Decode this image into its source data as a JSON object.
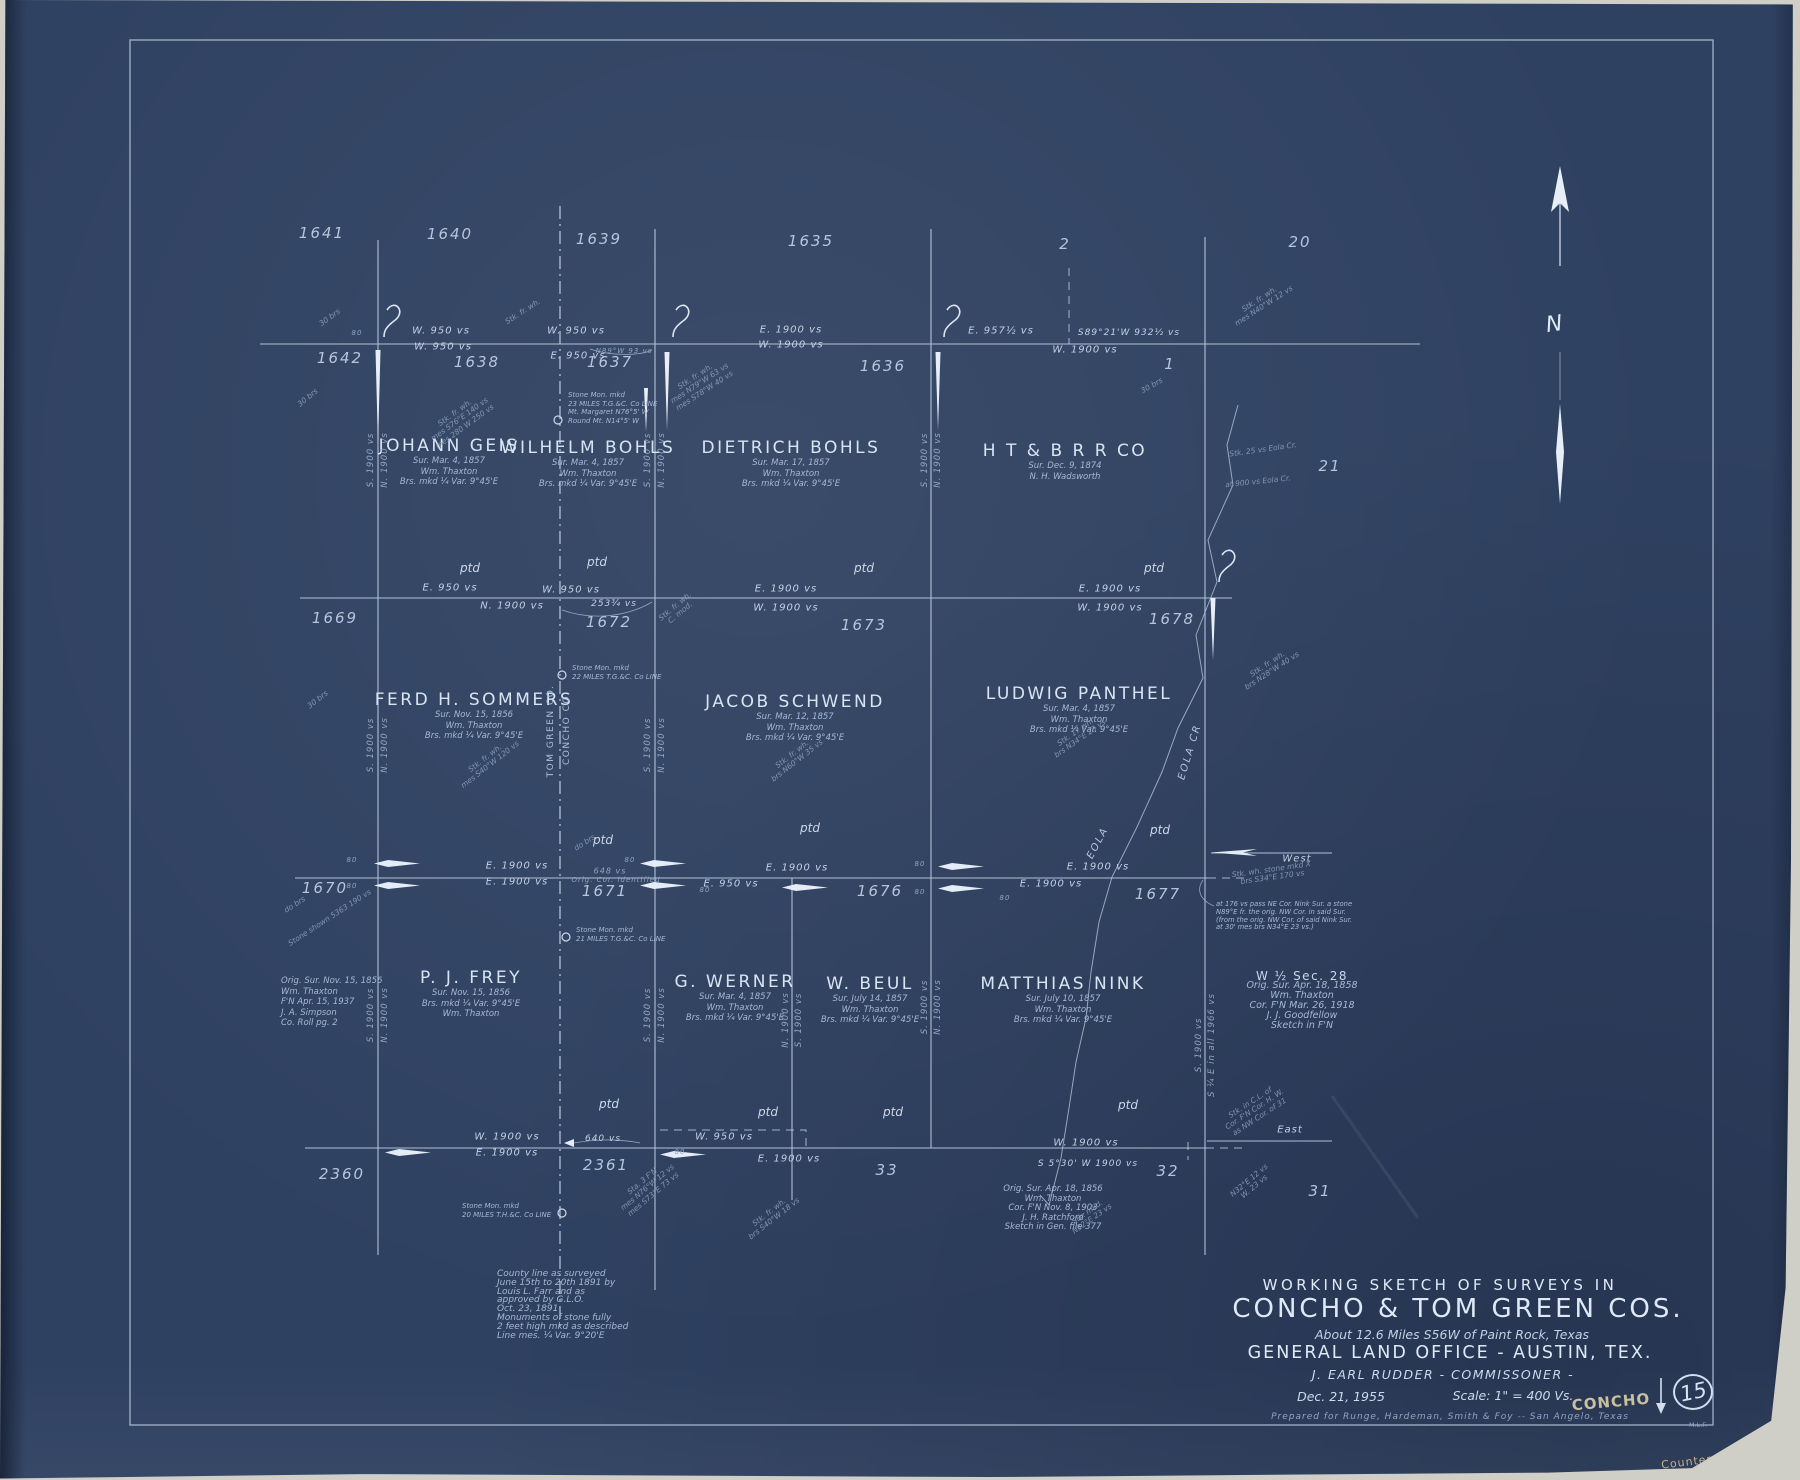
{
  "colors": {
    "paper": "#2f4161",
    "ink": "#c6d4e6",
    "ink_bright": "#e2ebf7",
    "ink_dim": "#8fa5c4",
    "pencil": "#bfb388"
  },
  "compass": {
    "letter": "N"
  },
  "title_block": {
    "line1": "WORKING SKETCH OF SURVEYS IN",
    "line2": "CONCHO & TOM GREEN COS.",
    "line3": "About 12.6 Miles S56W of Paint Rock, Texas",
    "line4": "GENERAL LAND OFFICE - AUSTIN, TEX.",
    "line5": "J. EARL RUDDER - COMMISSONER -",
    "date": "Dec. 21, 1955",
    "scale": "Scale: 1\" = 400 Vs.",
    "prepared": "Prepared for Runge, Hardeman, Smith & Foy -- San Angelo, Texas",
    "county_stamp": "CONCHO",
    "sheet_number": "15",
    "initials": "M.L.F.",
    "counter_note": "Counter # 68197"
  },
  "map": {
    "ptd_label": "ptd",
    "section_numbers": [
      {
        "t": "1641",
        "x": 322,
        "y": 233
      },
      {
        "t": "1640",
        "x": 450,
        "y": 234
      },
      {
        "t": "1639",
        "x": 599,
        "y": 239
      },
      {
        "t": "1635",
        "x": 811,
        "y": 241
      },
      {
        "t": "2",
        "x": 1065,
        "y": 244
      },
      {
        "t": "20",
        "x": 1300,
        "y": 242
      },
      {
        "t": "1642",
        "x": 340,
        "y": 358
      },
      {
        "t": "1638",
        "x": 477,
        "y": 362
      },
      {
        "t": "1637",
        "x": 610,
        "y": 362
      },
      {
        "t": "1636",
        "x": 883,
        "y": 366
      },
      {
        "t": "1",
        "x": 1170,
        "y": 364
      },
      {
        "t": "21",
        "x": 1330,
        "y": 466
      },
      {
        "t": "1669",
        "x": 335,
        "y": 618
      },
      {
        "t": "1672",
        "x": 609,
        "y": 622
      },
      {
        "t": "1673",
        "x": 864,
        "y": 625
      },
      {
        "t": "1678",
        "x": 1172,
        "y": 619
      },
      {
        "t": "1670",
        "x": 325,
        "y": 888
      },
      {
        "t": "1671",
        "x": 605,
        "y": 891
      },
      {
        "t": "1676",
        "x": 880,
        "y": 891
      },
      {
        "t": "1677",
        "x": 1158,
        "y": 894
      },
      {
        "t": "2360",
        "x": 342,
        "y": 1174
      },
      {
        "t": "2361",
        "x": 606,
        "y": 1165
      },
      {
        "t": "33",
        "x": 887,
        "y": 1170
      },
      {
        "t": "32",
        "x": 1168,
        "y": 1171
      },
      {
        "t": "31",
        "x": 1320,
        "y": 1191
      }
    ],
    "surveys": [
      {
        "name": "JOHANN GEIS",
        "x": 449,
        "y": 436,
        "sub": [
          "Sur. Mar. 4, 1857",
          "Wm. Thaxton",
          "Brs. mkd ¼ Var. 9°45'E"
        ]
      },
      {
        "name": "WILHELM BOHLS",
        "x": 588,
        "y": 438,
        "sub": [
          "Sur. Mar. 4, 1857",
          "Wm. Thaxton",
          "Brs. mkd ¼ Var. 9°45'E"
        ]
      },
      {
        "name": "DIETRICH BOHLS",
        "x": 791,
        "y": 438,
        "sub": [
          "Sur. Mar. 17, 1857",
          "Wm. Thaxton",
          "Brs. mkd ¼ Var. 9°45'E"
        ]
      },
      {
        "name": "H T & B R R CO",
        "x": 1065,
        "y": 441,
        "sub": [
          "Sur. Dec. 9, 1874",
          "N. H. Wadsworth"
        ]
      },
      {
        "name": "FERD H. SOMMERS",
        "x": 474,
        "y": 690,
        "sub": [
          "Sur. Nov. 15, 1856",
          "Wm. Thaxton",
          "Brs. mkd ¼ Var. 9°45'E"
        ]
      },
      {
        "name": "JACOB SCHWEND",
        "x": 795,
        "y": 692,
        "sub": [
          "Sur. Mar. 12, 1857",
          "Wm. Thaxton",
          "Brs. mkd ¼ Var. 9°45'E"
        ]
      },
      {
        "name": "LUDWIG PANTHEL",
        "x": 1079,
        "y": 684,
        "sub": [
          "Sur. Mar. 4, 1857",
          "Wm. Thaxton",
          "Brs. mkd ¼ Var. 9°45'E"
        ]
      },
      {
        "name": "P. J. FREY",
        "x": 471,
        "y": 968,
        "sub": [
          "Sur. Nov. 15, 1856",
          "Brs. mkd ¼ Var. 9°45'E",
          "Wm. Thaxton"
        ]
      },
      {
        "name": "G. WERNER",
        "x": 735,
        "y": 972,
        "sub": [
          "Sur. Mar. 4, 1857",
          "Wm. Thaxton",
          "Brs. mkd ¼ Var. 9°45'E"
        ]
      },
      {
        "name": "W. BEUL",
        "x": 870,
        "y": 974,
        "sub": [
          "Sur. July 14, 1857",
          "Wm. Thaxton",
          "Brs. mkd ¼ Var. 9°45'E"
        ]
      },
      {
        "name": "MATTHIAS NINK",
        "x": 1063,
        "y": 974,
        "sub": [
          "Sur. July 10, 1857",
          "Wm. Thaxton",
          "Brs. mkd ¼ Var. 9°45'E"
        ]
      }
    ],
    "line_labels": [
      {
        "t": "W. 950 vs",
        "x": 441,
        "y": 331
      },
      {
        "t": "W. 950 vs",
        "x": 443,
        "y": 347
      },
      {
        "t": "W. 950 vs",
        "x": 576,
        "y": 331
      },
      {
        "t": "E. 950 vs",
        "x": 578,
        "y": 356
      },
      {
        "t": "N89°W 93 vs",
        "x": 624,
        "y": 351,
        "fs": 7,
        "dim": 1
      },
      {
        "t": "E. 1900 vs",
        "x": 791,
        "y": 330
      },
      {
        "t": "W. 1900 vs",
        "x": 791,
        "y": 345
      },
      {
        "t": "E. 957½ vs",
        "x": 1001,
        "y": 331
      },
      {
        "t": "S89°21'W 932½ vs",
        "x": 1129,
        "y": 333,
        "fs": 9
      },
      {
        "t": "W. 1900 vs",
        "x": 1085,
        "y": 350
      },
      {
        "t": "E. 950 vs",
        "x": 450,
        "y": 588
      },
      {
        "t": "W. 950 vs",
        "x": 571,
        "y": 590
      },
      {
        "t": "N. 1900 vs",
        "x": 512,
        "y": 606
      },
      {
        "t": "253¾ vs",
        "x": 614,
        "y": 604,
        "fs": 9
      },
      {
        "t": "E. 1900 vs",
        "x": 786,
        "y": 589
      },
      {
        "t": "W. 1900 vs",
        "x": 786,
        "y": 608
      },
      {
        "t": "E. 1900 vs",
        "x": 1110,
        "y": 589
      },
      {
        "t": "W. 1900 vs",
        "x": 1110,
        "y": 608
      },
      {
        "t": "E. 1900 vs",
        "x": 517,
        "y": 866
      },
      {
        "t": "E. 1900 vs",
        "x": 517,
        "y": 882
      },
      {
        "t": "648 vs",
        "x": 610,
        "y": 871,
        "fs": 8,
        "dim": 1
      },
      {
        "t": "Orig. Cor. identified",
        "x": 616,
        "y": 880,
        "fs": 7,
        "dim": 1
      },
      {
        "t": "E. 950 vs",
        "x": 731,
        "y": 884
      },
      {
        "t": "E. 1900 vs",
        "x": 797,
        "y": 868
      },
      {
        "t": "E. 1900 vs",
        "x": 1098,
        "y": 867
      },
      {
        "t": "E. 1900 vs",
        "x": 1051,
        "y": 884
      },
      {
        "t": "West",
        "x": 1297,
        "y": 859
      },
      {
        "t": "W. 1900 vs",
        "x": 507,
        "y": 1137
      },
      {
        "t": "E. 1900 vs",
        "x": 507,
        "y": 1153
      },
      {
        "t": "640 vs",
        "x": 603,
        "y": 1139,
        "fs": 9
      },
      {
        "t": "W. 950 vs",
        "x": 724,
        "y": 1137
      },
      {
        "t": "E. 1900 vs",
        "x": 789,
        "y": 1159
      },
      {
        "t": "W. 1900 vs",
        "x": 1086,
        "y": 1143
      },
      {
        "t": "S 5°30' W 1900 vs",
        "x": 1088,
        "y": 1164,
        "fs": 9
      },
      {
        "t": "East",
        "x": 1290,
        "y": 1130
      },
      {
        "t": "80",
        "x": 357,
        "y": 333,
        "fs": 7,
        "dim": 1
      },
      {
        "t": "80",
        "x": 352,
        "y": 860,
        "fs": 7,
        "dim": 1
      },
      {
        "t": "80",
        "x": 352,
        "y": 886,
        "fs": 7,
        "dim": 1
      },
      {
        "t": "80",
        "x": 630,
        "y": 860,
        "fs": 7,
        "dim": 1
      },
      {
        "t": "80",
        "x": 705,
        "y": 890,
        "fs": 7,
        "dim": 1
      },
      {
        "t": "80",
        "x": 920,
        "y": 864,
        "fs": 7,
        "dim": 1
      },
      {
        "t": "80",
        "x": 920,
        "y": 892,
        "fs": 7,
        "dim": 1
      },
      {
        "t": "80",
        "x": 1005,
        "y": 898,
        "fs": 7,
        "dim": 1
      },
      {
        "t": "80",
        "x": 680,
        "y": 1152,
        "fs": 7,
        "dim": 1
      }
    ],
    "vara_labels": [
      {
        "t": "S. 1900 vs",
        "x": 371,
        "y": 460
      },
      {
        "t": "N. 1900 vs",
        "x": 385,
        "y": 460
      },
      {
        "t": "S. 1900 vs",
        "x": 371,
        "y": 745
      },
      {
        "t": "N. 1900 vs",
        "x": 385,
        "y": 745
      },
      {
        "t": "S. 1900 vs",
        "x": 371,
        "y": 1015
      },
      {
        "t": "N. 1900 vs",
        "x": 385,
        "y": 1015
      },
      {
        "t": "S. 1900 vs",
        "x": 648,
        "y": 460
      },
      {
        "t": "N. 1900 vs",
        "x": 662,
        "y": 460
      },
      {
        "t": "S. 1900 vs",
        "x": 648,
        "y": 745
      },
      {
        "t": "N. 1900 vs",
        "x": 662,
        "y": 745
      },
      {
        "t": "S. 1900 vs",
        "x": 648,
        "y": 1015
      },
      {
        "t": "N. 1900 vs",
        "x": 662,
        "y": 1015
      },
      {
        "t": "N. 1900 vs",
        "x": 786,
        "y": 1020
      },
      {
        "t": "S. 1900 vs",
        "x": 799,
        "y": 1020
      },
      {
        "t": "S. 1900 vs",
        "x": 925,
        "y": 460
      },
      {
        "t": "N. 1900 vs",
        "x": 938,
        "y": 460
      },
      {
        "t": "S. 1900 vs",
        "x": 925,
        "y": 1007
      },
      {
        "t": "N. 1900 vs",
        "x": 938,
        "y": 1007
      },
      {
        "t": "S. 1900 vs",
        "x": 1199,
        "y": 1045
      },
      {
        "t": "S ¼ E in all 1966 vs",
        "x": 1212,
        "y": 1045
      }
    ],
    "ptd": [
      [
        470,
        568
      ],
      [
        597,
        562
      ],
      [
        864,
        568
      ],
      [
        1154,
        568
      ],
      [
        603,
        840
      ],
      [
        810,
        828
      ],
      [
        1160,
        830
      ],
      [
        609,
        1104
      ],
      [
        768,
        1112
      ],
      [
        893,
        1112
      ],
      [
        1128,
        1105
      ]
    ],
    "county_labels": [
      {
        "t": "TOM GREEN CO.",
        "x": 551,
        "y": 731
      },
      {
        "t": "CONCHO CO.",
        "x": 567,
        "y": 728
      }
    ],
    "creek_labels": [
      {
        "t": "EOLA CR",
        "x": 1190,
        "y": 752,
        "r": -73
      },
      {
        "t": "EOLA",
        "x": 1098,
        "y": 843,
        "r": -62
      }
    ],
    "notes": [
      {
        "x": 281,
        "y": 976,
        "align": "left",
        "fs": 8.5,
        "lh": 10.5,
        "lines": [
          "Orig. Sur. Nov. 15, 1856",
          "Wm. Thaxton",
          "F'N Apr. 15, 1937",
          "J. A. Simpson",
          "Co. Roll pg. 2"
        ]
      },
      {
        "x": 1302,
        "y": 971,
        "align": "center",
        "fs": 9.5,
        "lh": 10,
        "big": true,
        "lines": [
          "W ½ Sec. 28",
          "Orig. Sur. Apr. 18, 1858",
          "Wm. Thaxton",
          "Cor. F'N Mar. 26, 1918",
          "J. J. Goodfellow",
          "Sketch in F'N"
        ]
      },
      {
        "x": 1053,
        "y": 1185,
        "align": "center",
        "fs": 8.5,
        "lh": 9.5,
        "lines": [
          "Orig. Sur. Apr. 18, 1856",
          "Wm. Thaxton",
          "Cor. F'N Nov. 8, 1903",
          "J. H. Ratchford",
          "Sketch in Gen. file 377"
        ]
      },
      {
        "x": 497,
        "y": 1270,
        "align": "left",
        "fs": 9,
        "lh": 8.8,
        "lines": [
          "County line as surveyed",
          "June 15th to 20th 1891 by",
          "Louis L. Farr and as",
          "approved by G.L.O.",
          "Oct. 23, 1891",
          "Monuments of stone fully",
          "2 feet high mkd as described",
          "Line mes. ¼ Var. 9°20'E"
        ]
      },
      {
        "x": 1216,
        "y": 901,
        "align": "left",
        "fs": 6.8,
        "lh": 7.8,
        "lines": [
          "at 176 vs pass NE Cor. Nink Sur. a stone",
          "N89°E fr. the orig. NW Cor. in said Sur.",
          "(from the orig. NW Cor. of said Nink Sur.",
          "at 30' mes brs N34°E 23 vs.)"
        ]
      }
    ],
    "monument_notes": [
      {
        "x": 568,
        "y": 391,
        "lines": [
          "Stone Mon. mkd",
          "23 MILES T.G.&C. Co LINE",
          "Mt. Margaret N76°5' W",
          "Round Mt. N14°5' W"
        ]
      },
      {
        "x": 572,
        "y": 664,
        "lines": [
          "Stone Mon. mkd",
          "22 MILES T.G.&C. Co LINE"
        ]
      },
      {
        "x": 576,
        "y": 926,
        "lines": [
          "Stone Mon. mkd",
          "21 MILES T.G.&C. Co LINE"
        ]
      },
      {
        "x": 462,
        "y": 1202,
        "lines": [
          "Stone Mon. mkd",
          "20 MILES T.H.&C. Co LINE"
        ]
      }
    ],
    "diag_notes": [
      {
        "x": 460,
        "y": 420,
        "r": -36,
        "lines": [
          "Stk. fr. wh.",
          "mes S76°E 140 vs",
          "mes 280 W 250 vs"
        ]
      },
      {
        "x": 330,
        "y": 318,
        "r": -36,
        "lines": [
          "30 brs"
        ]
      },
      {
        "x": 308,
        "y": 398,
        "r": -40,
        "lines": [
          "30 brs"
        ]
      },
      {
        "x": 523,
        "y": 312,
        "r": -33,
        "lines": [
          "Stk. fr. wh."
        ]
      },
      {
        "x": 700,
        "y": 384,
        "r": -33,
        "lines": [
          "Stk. fr. wh.",
          "mes N79°W 63 vs",
          "mes S78°W 40 vs"
        ]
      },
      {
        "x": 1152,
        "y": 386,
        "r": -30,
        "lines": [
          "30 brs"
        ]
      },
      {
        "x": 1262,
        "y": 303,
        "r": -33,
        "lines": [
          "Stk. fr. wh.",
          "mes N40°W 12 vs"
        ]
      },
      {
        "x": 1263,
        "y": 450,
        "r": -8,
        "lines": [
          "Stk. 25 vs Eola Cr."
        ]
      },
      {
        "x": 1258,
        "y": 482,
        "r": -6,
        "lines": [
          "at 900 vs Eola Cr."
        ]
      },
      {
        "x": 678,
        "y": 610,
        "r": -40,
        "lines": [
          "Stk. fr. wh.",
          "C. mod."
        ]
      },
      {
        "x": 1270,
        "y": 668,
        "r": -33,
        "lines": [
          "Stk. fr. wh.",
          "brs N28°W 40 vs"
        ]
      },
      {
        "x": 318,
        "y": 700,
        "r": -38,
        "lines": [
          "30 brs"
        ]
      },
      {
        "x": 488,
        "y": 762,
        "r": -38,
        "lines": [
          "Stk. fr. wh.",
          "mes S40°W 120 vs"
        ]
      },
      {
        "x": 795,
        "y": 758,
        "r": -38,
        "lines": [
          "Stk. fr. wh.",
          "brs N60°W 35 vs"
        ]
      },
      {
        "x": 1078,
        "y": 736,
        "r": -35,
        "lines": [
          "Stk. 17 wh.",
          "brs N34°E 23 vs"
        ]
      },
      {
        "x": 330,
        "y": 918,
        "r": -33,
        "lines": [
          "Stone shown 5363 190 vs"
        ]
      },
      {
        "x": 295,
        "y": 905,
        "r": -33,
        "lines": [
          "do brs"
        ]
      },
      {
        "x": 585,
        "y": 843,
        "r": -33,
        "lines": [
          "do brs"
        ]
      },
      {
        "x": 1272,
        "y": 874,
        "r": -8,
        "lines": [
          "Stk. wh. stone mkd X",
          "brs S34°E 170 vs"
        ]
      },
      {
        "x": 648,
        "y": 1188,
        "r": -40,
        "lines": [
          "Sta. 3 F'N",
          "mes N76°W 12 vs",
          "mes S73°E 73 vs"
        ]
      },
      {
        "x": 772,
        "y": 1216,
        "r": -38,
        "lines": [
          "Stk. fr. wh.",
          "brs S40°W 18 vs"
        ]
      },
      {
        "x": 1090,
        "y": 1216,
        "r": -35,
        "lines": [
          "Stk. mkd.",
          "N32°E 23 vs"
        ]
      },
      {
        "x": 1255,
        "y": 1110,
        "r": -33,
        "lines": [
          "Stk. in C.L. of",
          "Cor. F'N Cor. H. W.",
          "as NW Cor. of 31"
        ]
      },
      {
        "x": 1252,
        "y": 1184,
        "r": -40,
        "lines": [
          "N32°E 12 vs",
          "W. 23 vs"
        ]
      }
    ]
  }
}
